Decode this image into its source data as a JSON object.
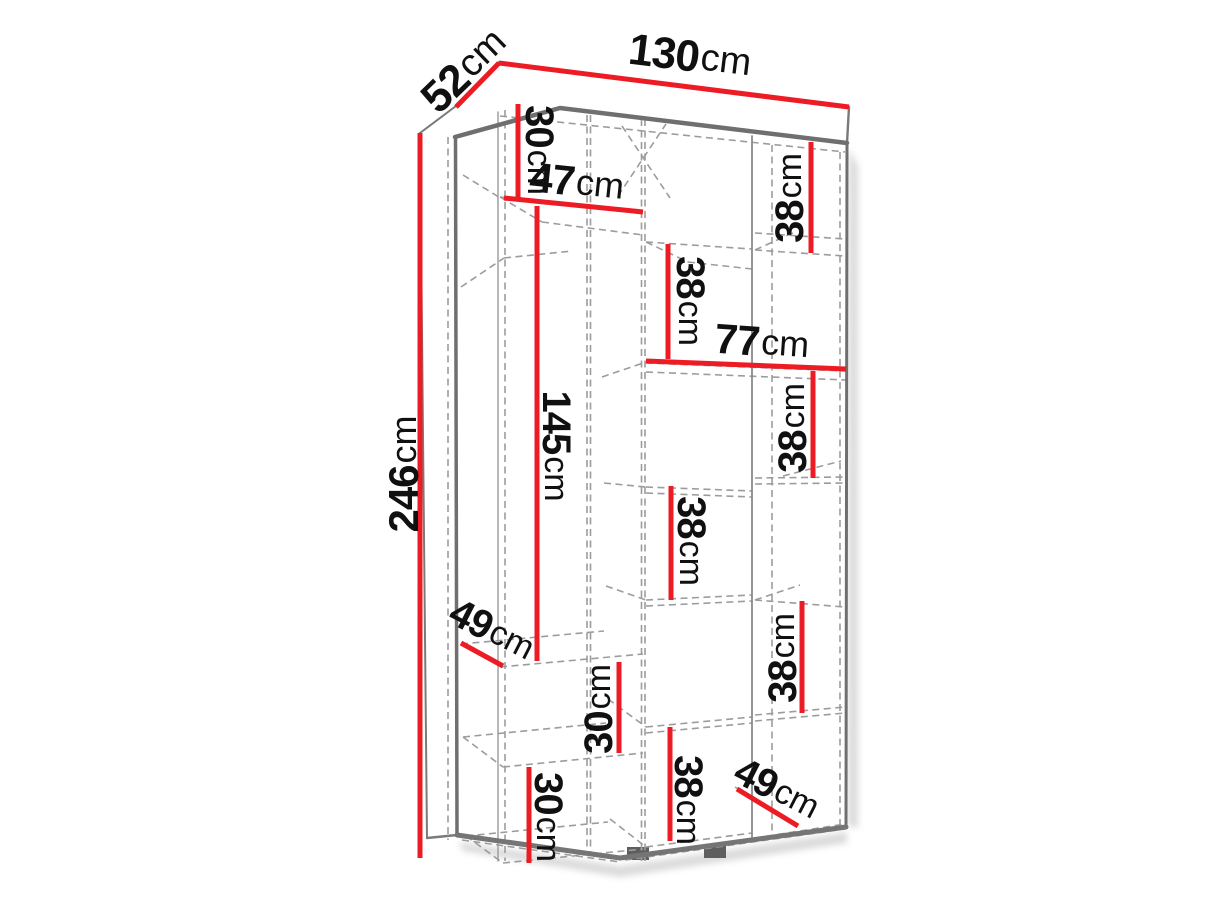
{
  "page": {
    "background": "#ffffff",
    "title": "Wardrobe interior dimensions diagram"
  },
  "diagram": {
    "type": "furniture-dimension-diagram",
    "subject": "wardrobe-internal-shelf-dimensions",
    "unit": "cm",
    "accent_color": "#ed1c24",
    "outline_color": "#6f6f6f",
    "dash_color": "#9c9c9c",
    "overall": {
      "width_cm": 130,
      "depth_cm": 52,
      "height_cm": 246
    },
    "dimensions": [
      {
        "id": "depth-52",
        "value": "52",
        "unit": "cm",
        "line": {
          "x1": 456,
          "y1": 107,
          "x2": 499,
          "y2": 63
        },
        "label": {
          "x": 464,
          "y": 70,
          "rotate": -44,
          "size": 44
        }
      },
      {
        "id": "width-130",
        "value": "130",
        "unit": "cm",
        "line": {
          "x1": 499,
          "y1": 63,
          "x2": 849,
          "y2": 107
        },
        "label": {
          "x": 690,
          "y": 56,
          "rotate": 7,
          "size": 44
        }
      },
      {
        "id": "height-246",
        "value": "246",
        "unit": "cm",
        "line": {
          "x1": 420,
          "y1": 133,
          "x2": 420,
          "y2": 858
        },
        "label": {
          "x": 403,
          "y": 474,
          "rotate": -90,
          "size": 42
        }
      },
      {
        "id": "top-left-30",
        "value": "30",
        "unit": "cm",
        "line": {
          "x1": 518,
          "y1": 104,
          "x2": 518,
          "y2": 198
        },
        "label": {
          "x": 539,
          "y": 150,
          "rotate": 90,
          "size": 40
        }
      },
      {
        "id": "shelf-47",
        "value": "47",
        "unit": "cm",
        "line": {
          "x1": 504,
          "y1": 198,
          "x2": 643,
          "y2": 212
        },
        "label": {
          "x": 577,
          "y": 181,
          "rotate": 6,
          "size": 42
        }
      },
      {
        "id": "top-right-38",
        "value": "38",
        "unit": "cm",
        "line": {
          "x1": 811,
          "y1": 142,
          "x2": 811,
          "y2": 253
        },
        "label": {
          "x": 790,
          "y": 198,
          "rotate": -90,
          "size": 40
        }
      },
      {
        "id": "mid-top-38",
        "value": "38",
        "unit": "cm",
        "line": {
          "x1": 668,
          "y1": 244,
          "x2": 668,
          "y2": 359
        },
        "label": {
          "x": 690,
          "y": 301,
          "rotate": 90,
          "size": 40
        }
      },
      {
        "id": "shelf-77",
        "value": "77",
        "unit": "cm",
        "line": {
          "x1": 646,
          "y1": 361,
          "x2": 846,
          "y2": 369
        },
        "label": {
          "x": 762,
          "y": 341,
          "rotate": 4,
          "size": 42
        }
      },
      {
        "id": "left-145",
        "value": "145",
        "unit": "cm",
        "line": {
          "x1": 537,
          "y1": 206,
          "x2": 537,
          "y2": 661
        },
        "label": {
          "x": 556,
          "y": 446,
          "rotate": 90,
          "size": 40
        }
      },
      {
        "id": "right-mid-38",
        "value": "38",
        "unit": "cm",
        "line": {
          "x1": 813,
          "y1": 371,
          "x2": 813,
          "y2": 478
        },
        "label": {
          "x": 793,
          "y": 428,
          "rotate": -90,
          "size": 40
        }
      },
      {
        "id": "mid-38",
        "value": "38",
        "unit": "cm",
        "line": {
          "x1": 671,
          "y1": 486,
          "x2": 671,
          "y2": 600
        },
        "label": {
          "x": 691,
          "y": 541,
          "rotate": 90,
          "size": 40
        }
      },
      {
        "id": "left-depth-49",
        "value": "49",
        "unit": "cm",
        "line": {
          "x1": 461,
          "y1": 643,
          "x2": 503,
          "y2": 666
        },
        "label": {
          "x": 492,
          "y": 630,
          "rotate": 27,
          "size": 40
        }
      },
      {
        "id": "mid-low-30",
        "value": "30",
        "unit": "cm",
        "line": {
          "x1": 619,
          "y1": 662,
          "x2": 619,
          "y2": 753
        },
        "label": {
          "x": 599,
          "y": 709,
          "rotate": -90,
          "size": 40
        }
      },
      {
        "id": "right-low-38",
        "value": "38",
        "unit": "cm",
        "line": {
          "x1": 802,
          "y1": 601,
          "x2": 802,
          "y2": 713
        },
        "label": {
          "x": 783,
          "y": 658,
          "rotate": -90,
          "size": 40
        }
      },
      {
        "id": "bottom-left-30",
        "value": "30",
        "unit": "cm",
        "line": {
          "x1": 529,
          "y1": 767,
          "x2": 529,
          "y2": 863
        },
        "label": {
          "x": 548,
          "y": 817,
          "rotate": 90,
          "size": 40
        }
      },
      {
        "id": "bottom-mid-38",
        "value": "38",
        "unit": "cm",
        "line": {
          "x1": 670,
          "y1": 727,
          "x2": 670,
          "y2": 841
        },
        "label": {
          "x": 688,
          "y": 800,
          "rotate": 90,
          "size": 40
        }
      },
      {
        "id": "bottom-depth-49",
        "value": "49",
        "unit": "cm",
        "line": {
          "x1": 737,
          "y1": 789,
          "x2": 798,
          "y2": 826
        },
        "label": {
          "x": 777,
          "y": 789,
          "rotate": 27,
          "size": 40
        }
      }
    ]
  }
}
